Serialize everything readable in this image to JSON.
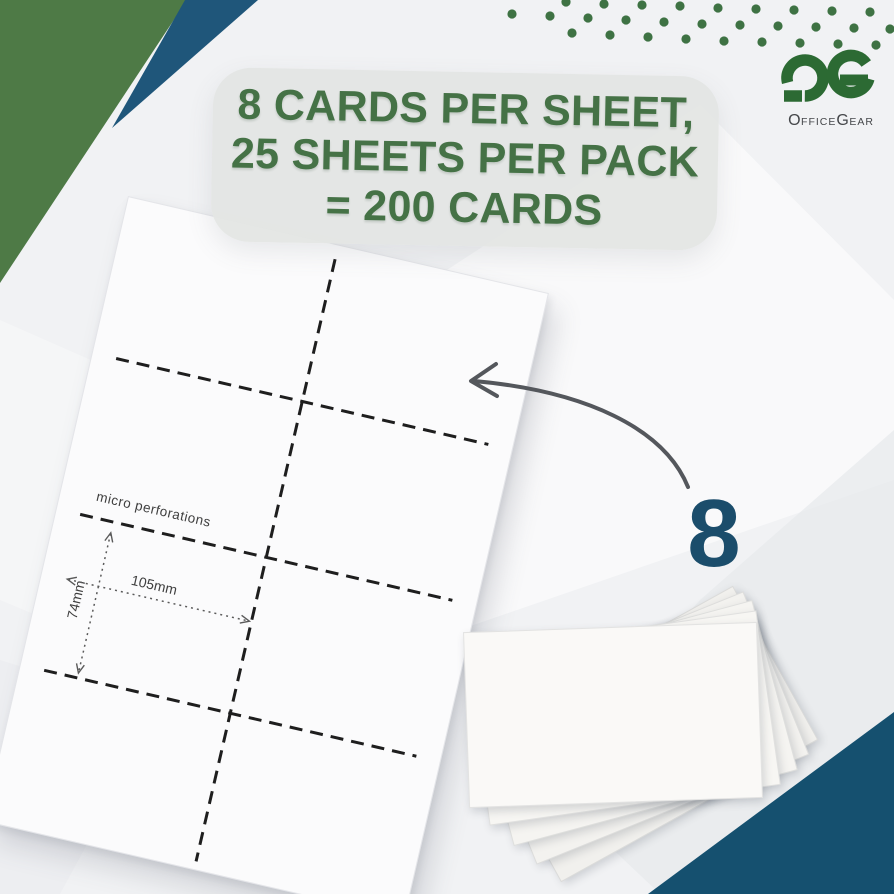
{
  "headline": {
    "line1": "8 CARDS PER SHEET,",
    "line2": "25 SHEETS PER PACK",
    "line3": "= 200 CARDS"
  },
  "callout": {
    "count": "8"
  },
  "sheet": {
    "micro_perforations_label": "micro perforations",
    "card_width_label": "105mm",
    "card_height_label": "74mm"
  },
  "logo": {
    "brand": "OfficeGear",
    "part1": "O",
    "part2": "FFICE",
    "part3": "G",
    "part4": "EAR"
  },
  "colors": {
    "background": "#f1f2f4",
    "wedge_green": "#4e7a46",
    "navy_wedge": "#1f567a",
    "deep_navy_triangle": "#15506f",
    "headline_green": "#457246",
    "logo_green": "#2c6a33",
    "dot_green": "#3e7243",
    "callout_navy": "#1b4d6b"
  }
}
